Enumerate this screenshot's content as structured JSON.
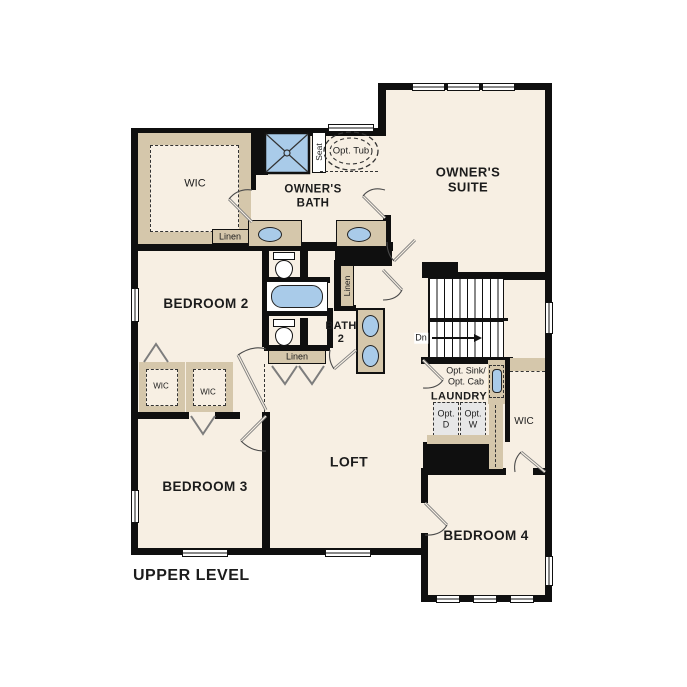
{
  "plan_title": "UPPER LEVEL",
  "colors": {
    "wall": "#0f0f0f",
    "floor": "#f7efe3",
    "cabinet": "#d5c7ab",
    "fixture_blue": "#a9cbe9",
    "optional_fill": "#e7e7e7"
  },
  "rooms": {
    "owners_suite": "OWNER'S\nSUITE",
    "owners_bath": "OWNER'S\nBATH",
    "bedroom2": "BEDROOM 2",
    "bedroom3": "BEDROOM 3",
    "bedroom4": "BEDROOM 4",
    "loft": "LOFT",
    "laundry": "LAUNDRY",
    "bath2": "BATH\n2",
    "owners_wic": "WIC",
    "bedroom2_wic": "WIC",
    "bedroom3_wic": "WIC",
    "bedroom4_wic": "WIC"
  },
  "closets": {
    "linen_owners": "Linen",
    "linen_bath2": "Linen",
    "linen_hall": "Linen"
  },
  "fixtures": {
    "shower_seat": "Seat",
    "optional_tub": "Opt. Tub",
    "optional_sink_cabinet": "Opt. Sink/\nOpt. Cab",
    "optional_dryer": "Opt.\nD",
    "optional_washer": "Opt.\nW",
    "stairs_direction": "Dn"
  }
}
